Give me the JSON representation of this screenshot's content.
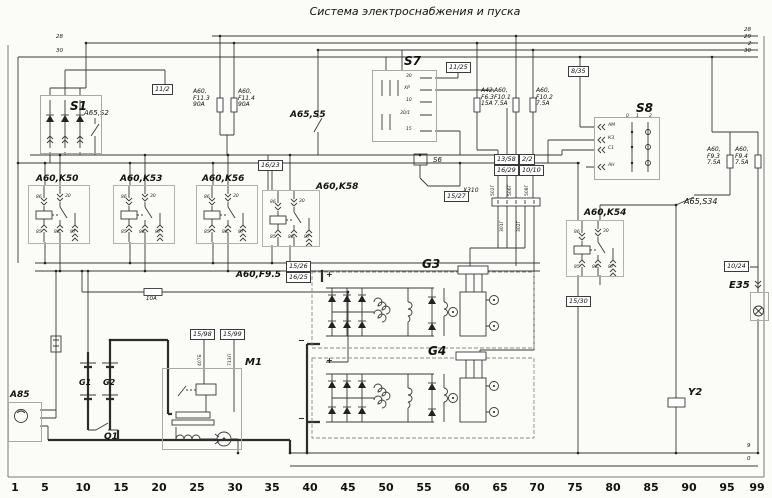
{
  "title": "Система электроснабжения и пуска",
  "ruler": [
    "1",
    "5",
    "10",
    "15",
    "20",
    "25",
    "30",
    "35",
    "40",
    "45",
    "50",
    "55",
    "60",
    "65",
    "70",
    "75",
    "80",
    "85",
    "90",
    "95",
    "99"
  ],
  "bus": {
    "l_28": "28",
    "l_30": "30",
    "r_28": "28",
    "r_29": "29",
    "r_2": "2",
    "r_30": "30",
    "gnd_9": "9",
    "gnd_0": "0"
  },
  "devices": {
    "s1": "S1",
    "s2": "A65,S2",
    "s5": "A65,S5",
    "s6": "S6",
    "s7": "S7",
    "s8": "S8",
    "s34": "A65,S34",
    "k50": "A60,K50",
    "k53": "A60,K53",
    "k56": "A60,K56",
    "k58": "A60,K58",
    "k54": "A60,K54",
    "g1": "G1",
    "g2": "G2",
    "g3": "G3",
    "g4": "G4",
    "m1": "M1",
    "q1": "Q1",
    "y2": "Y2",
    "e35": "E35",
    "a85": "A85",
    "x310": "X310"
  },
  "fuses": {
    "f113": "A60,\nF11.3\n90A",
    "f114": "A60,\nF11.4\n90A",
    "f63": "A42,\nF6.3\n15A",
    "f101": "A60,\nF10.1\n7.5A",
    "f102": "A60,\nF10.2\n7.5A",
    "f93": "A60,\nF9.3\n7.5A",
    "f94": "A60,\nF9.4\n7.5A",
    "f95": "A60,F9.5",
    "f95_rating": "10A"
  },
  "refs": {
    "r11_2": "11/2",
    "r11_25": "11/25",
    "r8_35": "8/35",
    "r16_23": "16/23",
    "r15_27": "15/27",
    "r13_58": "13/58",
    "r16_29": "16/29",
    "r2_2": "2/2",
    "r10_10": "10/10",
    "r15_26": "15/26",
    "r16_25": "16/25",
    "r15_30": "15/30",
    "r10_24": "10/24",
    "r15_98": "15/98",
    "r15_99": "15/99"
  },
  "relay_terms": {
    "t86": "86",
    "t30": "30",
    "t85": "85",
    "t88": "88",
    "t87": "87"
  },
  "s7_terms": [
    "30",
    "ХР",
    "10",
    "30/1",
    "15"
  ],
  "s8_terms": [
    "АМ",
    "КЗ",
    "С1",
    "АН"
  ],
  "s8_positions": [
    "0",
    "1",
    "2"
  ],
  "wire_tags": [
    "502Г",
    "506Г",
    "508Г",
    "301Г",
    "302Г",
    "407Б",
    "713Л"
  ],
  "signs": {
    "plus": "+",
    "minus": "−"
  }
}
